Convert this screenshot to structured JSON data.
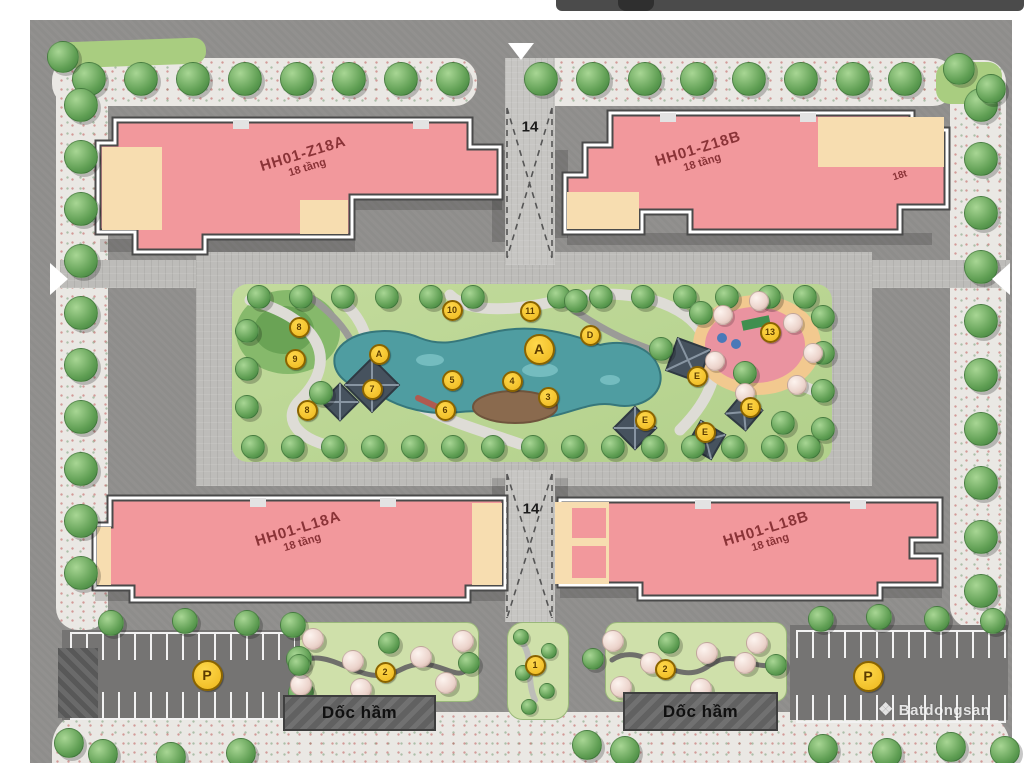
{
  "map": {
    "buildings": [
      {
        "name": "HH01-Z18A",
        "floors": "18 tầng"
      },
      {
        "name": "HH01-Z18B",
        "floors": "18 tầng",
        "side_note": "18t"
      },
      {
        "name": "HH01-L18A",
        "floors": "18 tầng"
      },
      {
        "name": "HH01-L18B",
        "floors": "18 tầng"
      }
    ],
    "zone_labels": [
      "14",
      "14"
    ],
    "ramp_label": "Dốc hầm",
    "park_markers": [
      {
        "label": "8",
        "x": 297,
        "y": 325
      },
      {
        "label": "9",
        "x": 293,
        "y": 357
      },
      {
        "label": "A",
        "x": 377,
        "y": 352
      },
      {
        "label": "7",
        "x": 370,
        "y": 387
      },
      {
        "label": "8",
        "x": 305,
        "y": 408
      },
      {
        "label": "10",
        "x": 450,
        "y": 308
      },
      {
        "label": "11",
        "x": 528,
        "y": 309
      },
      {
        "label": "D",
        "x": 588,
        "y": 333
      },
      {
        "label": "A",
        "x": 537,
        "y": 347,
        "large": true
      },
      {
        "label": "5",
        "x": 450,
        "y": 378
      },
      {
        "label": "4",
        "x": 510,
        "y": 379
      },
      {
        "label": "3",
        "x": 546,
        "y": 395
      },
      {
        "label": "6",
        "x": 443,
        "y": 408
      },
      {
        "label": "13",
        "x": 768,
        "y": 330
      },
      {
        "label": "E",
        "x": 695,
        "y": 374
      },
      {
        "label": "E",
        "x": 748,
        "y": 405
      },
      {
        "label": "E",
        "x": 643,
        "y": 418
      },
      {
        "label": "E",
        "x": 703,
        "y": 430
      }
    ],
    "garden_markers": [
      {
        "label": "2",
        "x": 383,
        "y": 670
      },
      {
        "label": "1",
        "x": 533,
        "y": 663
      },
      {
        "label": "2",
        "x": 663,
        "y": 667
      }
    ],
    "parking_markers": [
      {
        "label": "P",
        "x": 205,
        "y": 673
      },
      {
        "label": "P",
        "x": 866,
        "y": 674
      }
    ],
    "watermark": "Batdongsan",
    "colors": {
      "building": "#f2989c",
      "building_alt": "#f7ddb0",
      "label": "#8a3337",
      "lake": "#4f9da1",
      "park": "#bcd795",
      "marker": "#edb61b",
      "playground": "#ea93a0",
      "ramp": "#616161",
      "road": "#8e8d8b"
    }
  }
}
